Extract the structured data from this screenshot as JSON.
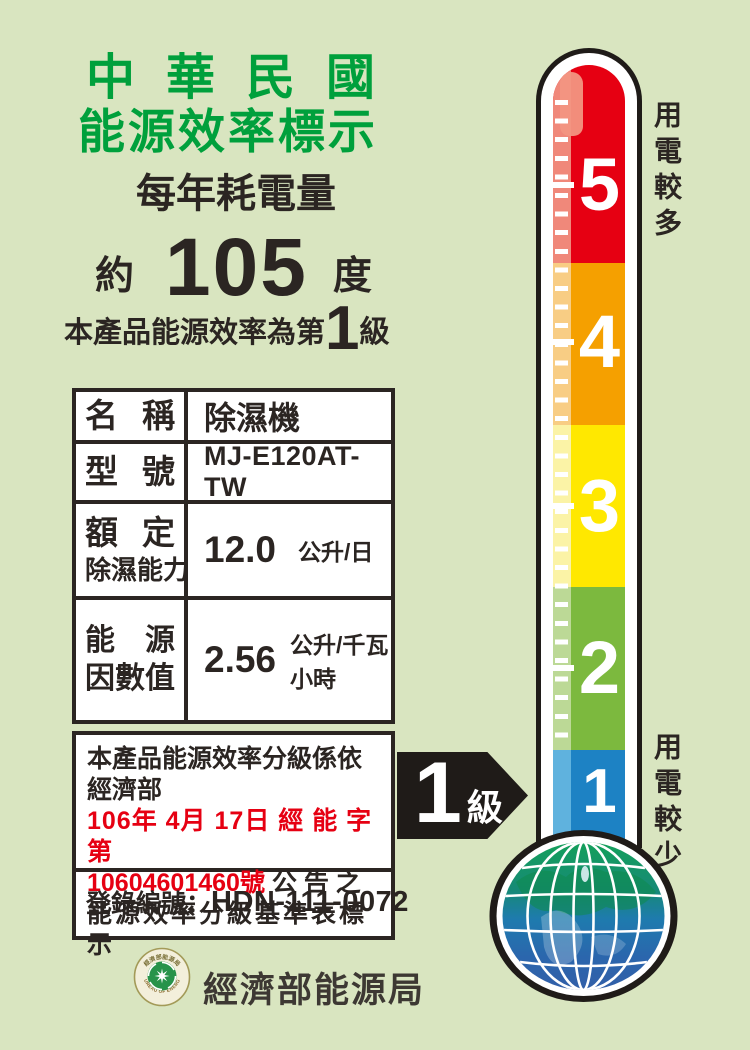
{
  "header": {
    "title_line1": "中華民國",
    "title_line2": "能源效率標示",
    "annual_consumption_label": "每年耗電量",
    "approx": "約",
    "consumption_value": "105",
    "consumption_unit": "度",
    "grade_sentence_prefix": "本產品能源效率為第",
    "grade_value": "1",
    "grade_sentence_suffix": "級"
  },
  "spec_table": {
    "rows": [
      {
        "label": [
          "名",
          "稱"
        ],
        "value": "除濕機"
      },
      {
        "label": [
          "型",
          "號"
        ],
        "value": "MJ-E120AT-TW"
      },
      {
        "label_line1": [
          "額",
          "定"
        ],
        "label_line2": [
          "除",
          "濕",
          "能",
          "力"
        ],
        "value": "12.0",
        "unit": "公升/日"
      },
      {
        "label_line1": [
          "能",
          "源"
        ],
        "label_line2": [
          "因",
          "數",
          "值"
        ],
        "value": "2.56",
        "unit": "公升/千瓦小時"
      }
    ]
  },
  "note": {
    "line1": "本產品能源效率分級係依經濟部",
    "line2_red": "106年 4月 17日 經 能 字 第",
    "line3_red": "10604601460號",
    "line3_black": "公 告 之",
    "line4": "能源效率分級基準表標示"
  },
  "registration": {
    "label": "登錄編號：",
    "number": "HDN-111-0072"
  },
  "footer": {
    "agency": "經濟部能源局",
    "logo_text_top": "經濟部能源局",
    "logo_text_bottom": "BUREAU OF ENERGY"
  },
  "thermometer": {
    "more_power_label": "用電較多",
    "less_power_label": "用電較少",
    "arrow_grade": "1",
    "arrow_grade_unit": "級",
    "levels": [
      {
        "value": "5",
        "color": "#e60012",
        "light": "#f0887a"
      },
      {
        "value": "4",
        "color": "#f5a000",
        "light": "#f8cd84"
      },
      {
        "value": "3",
        "color": "#ffe800",
        "light": "#fbf3a6"
      },
      {
        "value": "2",
        "color": "#7cb93e",
        "light": "#bcd996"
      },
      {
        "value": "1",
        "color": "#1d82c4",
        "light": "#5fb2de"
      }
    ]
  },
  "colors": {
    "background": "#d9e5c0",
    "title_green": "#00a03c",
    "red_text": "#e60012",
    "ink_black": "#2b2522",
    "arrow_black": "#1f1b18"
  }
}
